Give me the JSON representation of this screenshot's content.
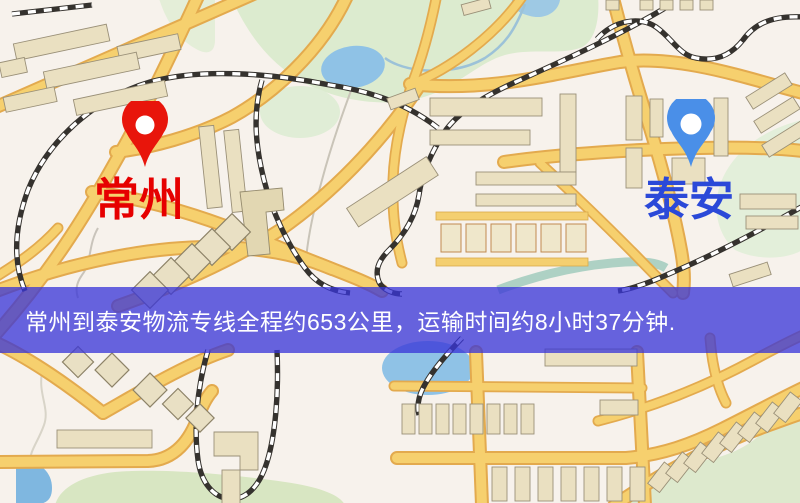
{
  "banner": {
    "text": "常州到泰安物流专线全程约653公里，运输时间约8小时37分钟.",
    "background_color": "#3835d8",
    "text_color": "#ffffff"
  },
  "markers": {
    "origin": {
      "label": "常州",
      "label_color": "#e60000",
      "pin_color": "#e8150b"
    },
    "destination": {
      "label": "泰安",
      "label_color": "#2b49d8",
      "pin_color": "#4a8fe8"
    }
  },
  "route": {
    "origin": "常州",
    "destination": "泰安",
    "distance_text": "约653公里",
    "duration_text": "约8小时37分钟"
  },
  "map_colors": {
    "background": "#f7f2ec",
    "road_fill": "#f6d06e",
    "road_border": "#e3aa4e",
    "building": "#eae0c1",
    "park_green": "#dcebcf",
    "water_blue": "#8fc2e6",
    "railway": "#35322e"
  }
}
